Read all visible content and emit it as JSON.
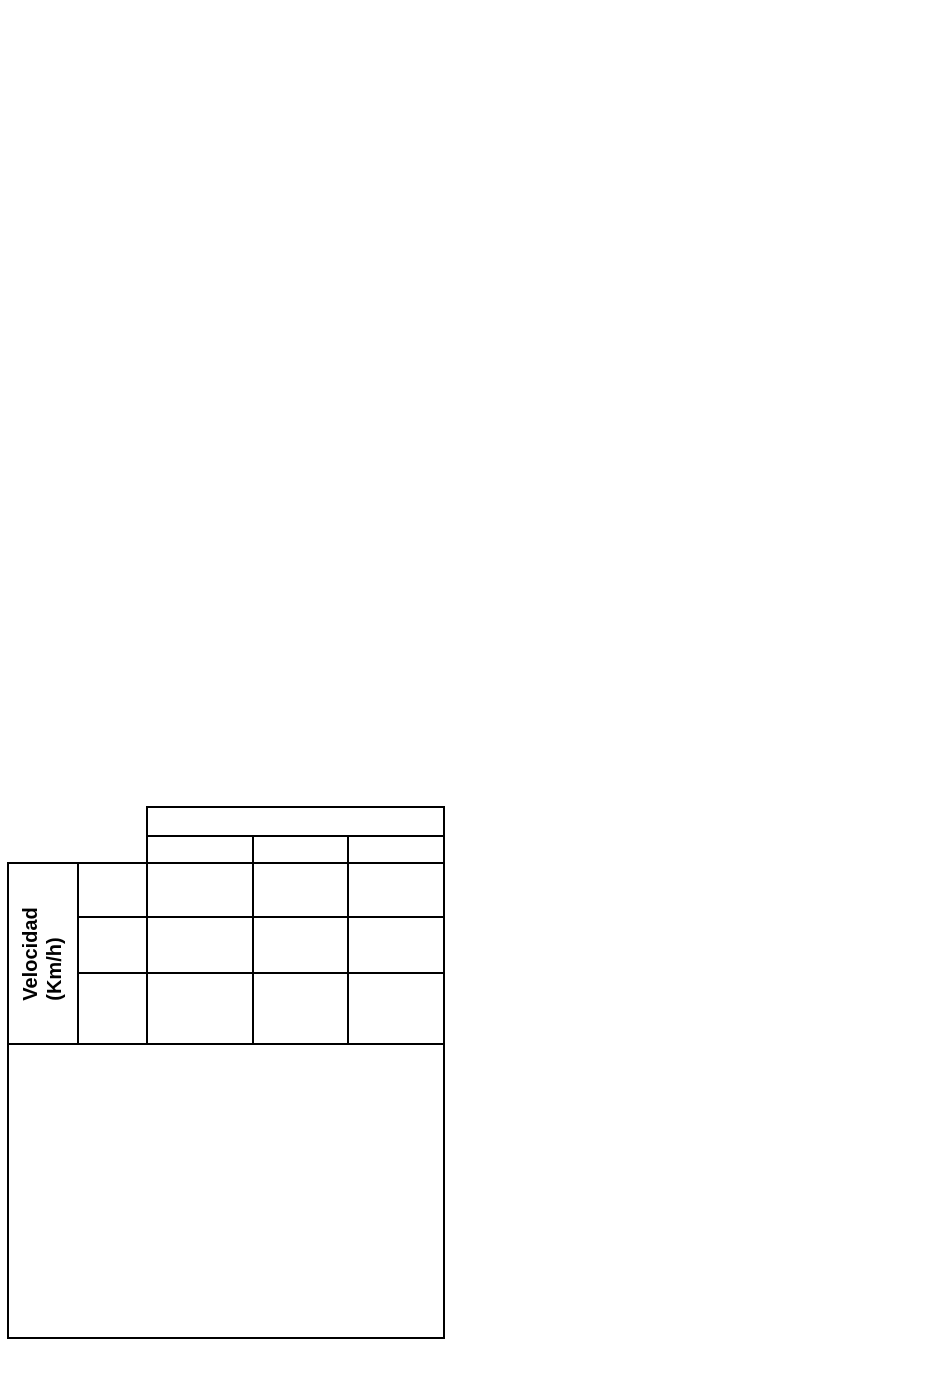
{
  "page": {
    "background_color": "#ffffff",
    "border_color": "#000000",
    "text_color": "#000000"
  },
  "table": {
    "velocity_label": {
      "line1": "Velocidad",
      "line2": "(Km/h)"
    },
    "top_header_band": "",
    "sub_headers": [
      "",
      "",
      ""
    ],
    "value_column_cells": [
      "",
      "",
      ""
    ],
    "data_rows": [
      [
        "",
        "",
        ""
      ],
      [
        "",
        "",
        ""
      ],
      [
        "",
        "",
        ""
      ]
    ],
    "graph_box": ""
  }
}
